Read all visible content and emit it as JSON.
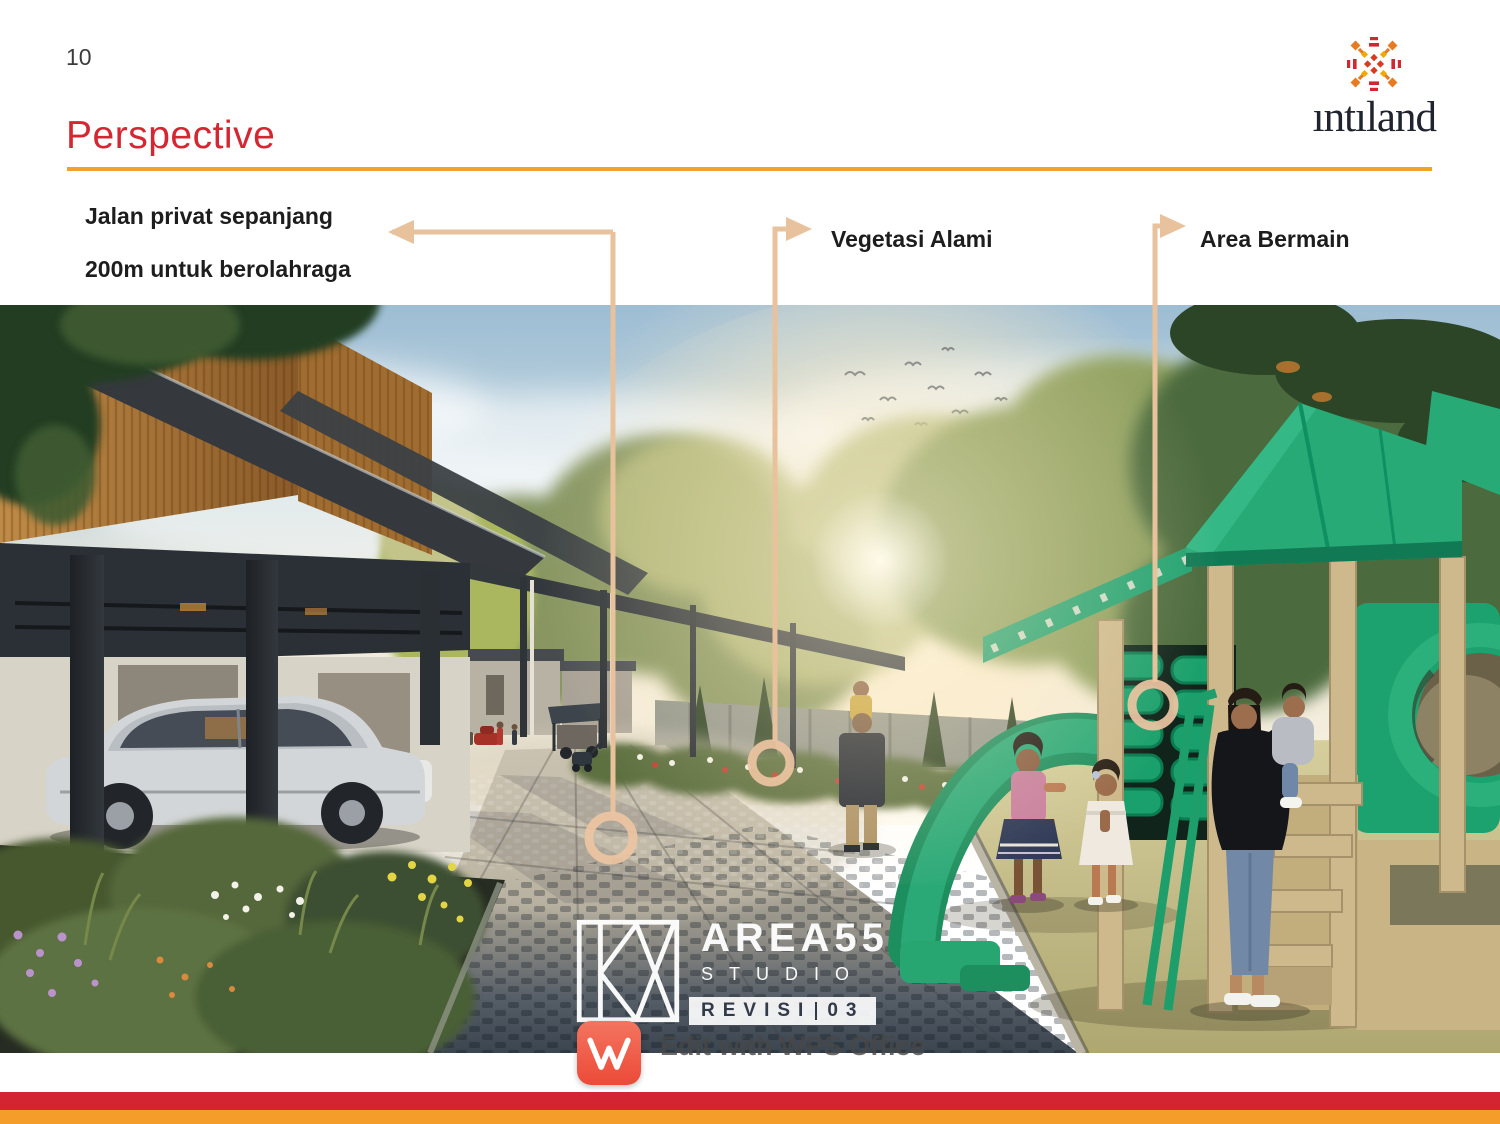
{
  "page": {
    "number": "10",
    "title": "Perspective"
  },
  "brand": {
    "wordmark": "ıntıland"
  },
  "annotations": {
    "private_road_line1": "Jalan privat sepanjang",
    "private_road_line2": "200m untuk berolahraga",
    "vegetation": "Vegetasi Alami",
    "playground": "Area Bermain"
  },
  "watermarks": {
    "studio_name": "AREA55",
    "studio_subtitle": "STUDIO",
    "revision_label": "REVISI",
    "revision_number": "03",
    "wps_edit_text": "Edit with WPS Office",
    "wps_initial": "W"
  },
  "colors": {
    "title_red": "#d52733",
    "divider_orange": "#f0a22b",
    "annotation_line_tan": "#e8c29d",
    "stripe_red": "#d22531",
    "stripe_orange": "#f59d2a",
    "wps_red": "#ee5a45",
    "playground_green": "#28aa77"
  }
}
